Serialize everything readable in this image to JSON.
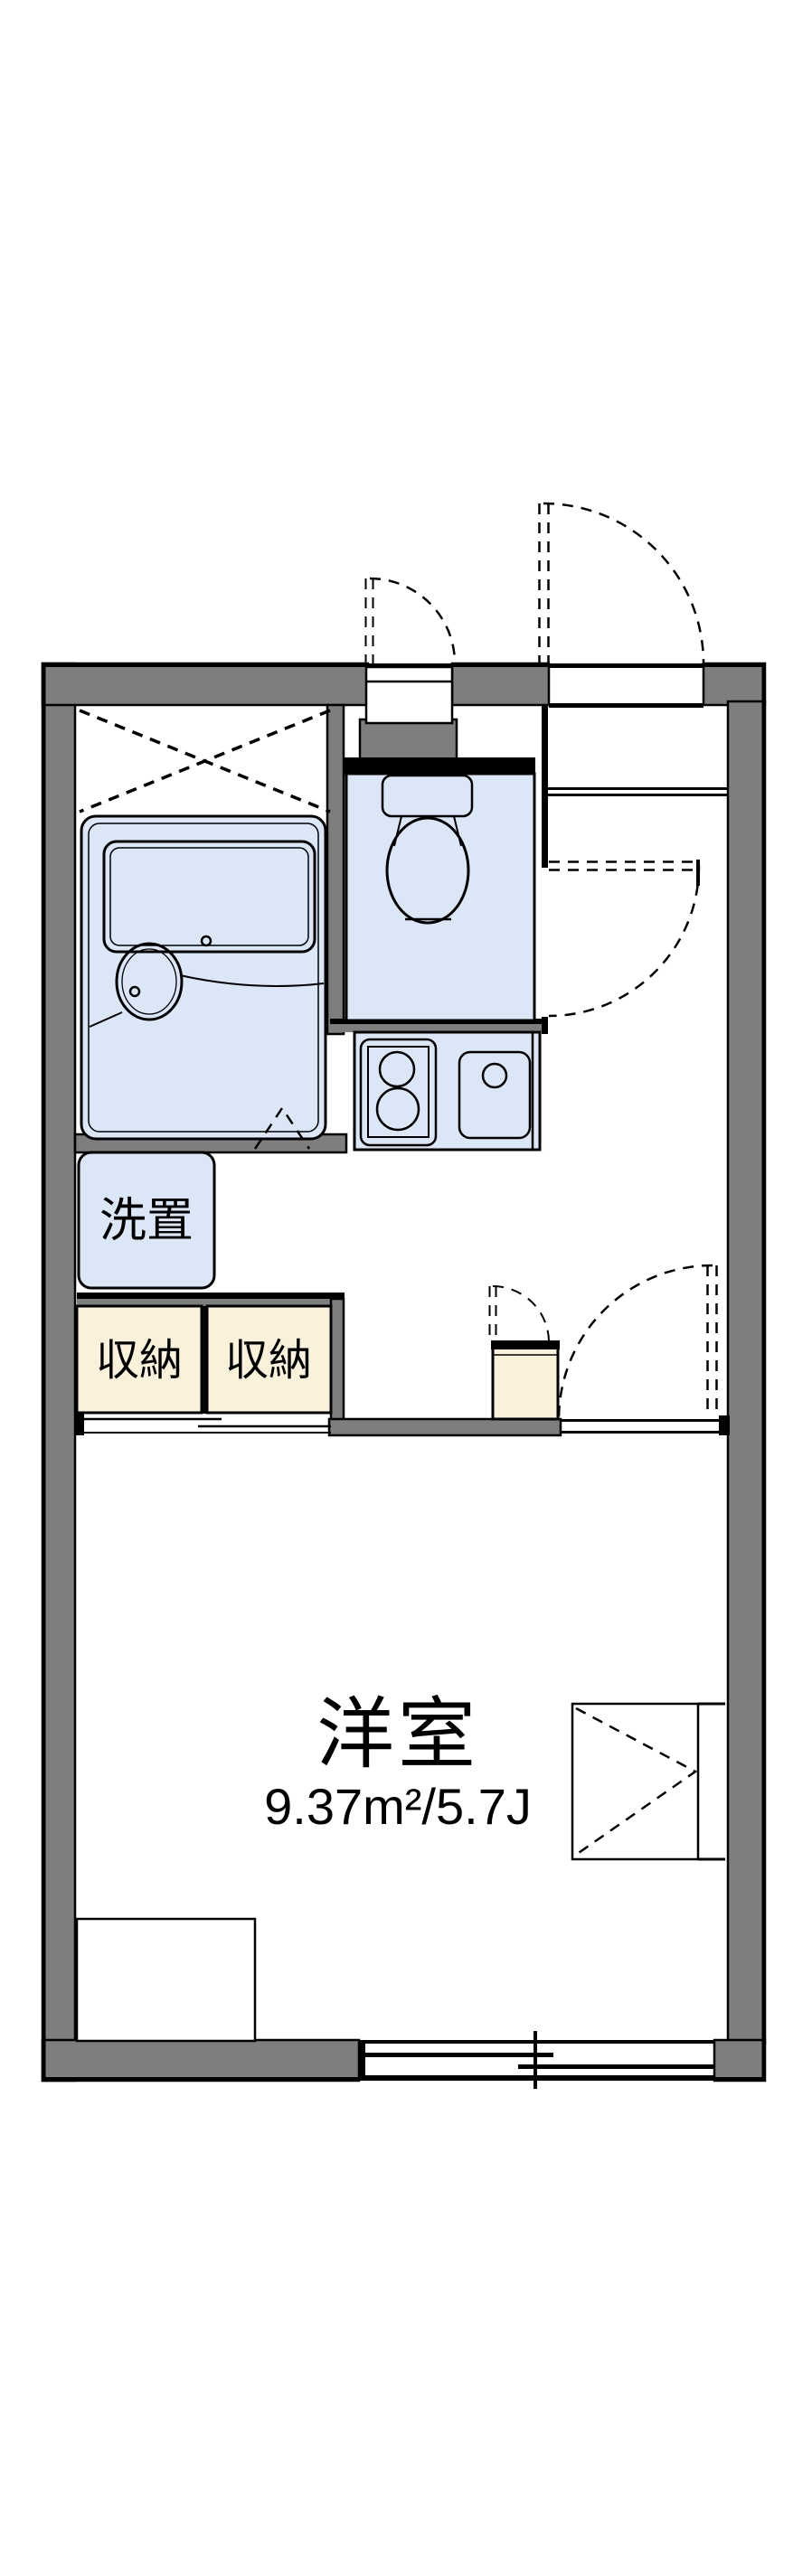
{
  "plan": {
    "type": "japanese-apartment-floor-plan",
    "labels": {
      "washer": "洗置",
      "storage_left": "収納",
      "storage_right": "収納",
      "room_name": "洋室",
      "room_area": "9.37m²/5.7J"
    },
    "colors": {
      "wall_gray": "#7e7e7e",
      "fixture_blue": "#dbe6f7",
      "storage_tan": "#faf1da",
      "line_black": "#000000",
      "background": "#ffffff"
    }
  }
}
